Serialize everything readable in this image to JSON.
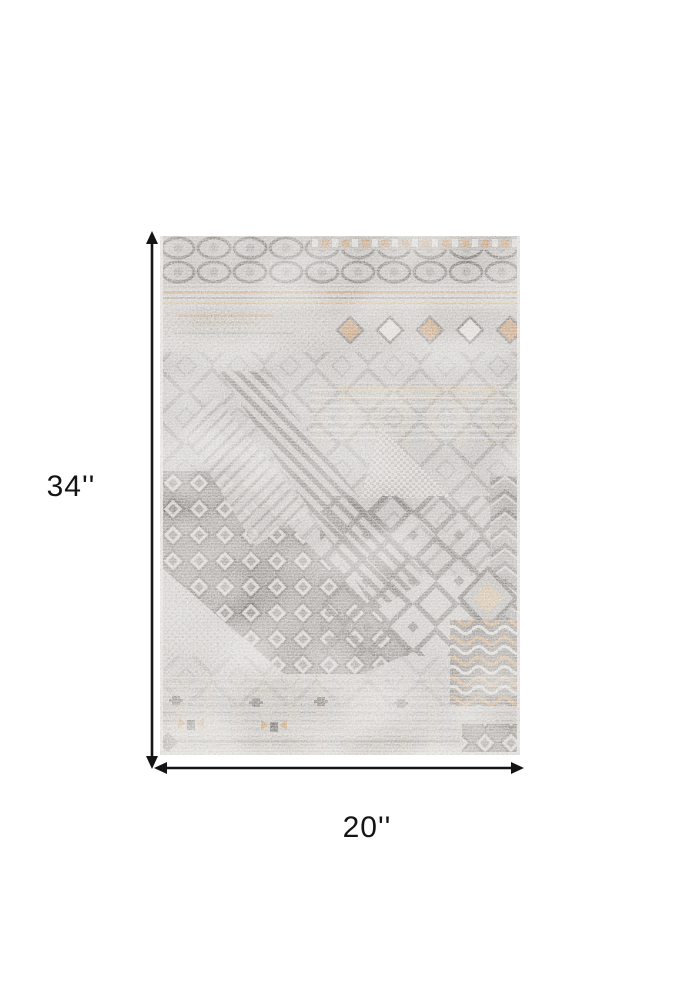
{
  "diagram": {
    "product": {
      "name": "distressed gray patchwork area rug"
    },
    "height": {
      "label": "34''"
    },
    "width": {
      "label": "20''"
    },
    "colors": {
      "background": "#ffffff",
      "arrow": "#141414",
      "text": "#141414",
      "rug_base": "#bdbab7",
      "rug_dark": "#59544f",
      "rug_rust": "#b5804f",
      "rug_tan": "#c9a571"
    }
  }
}
